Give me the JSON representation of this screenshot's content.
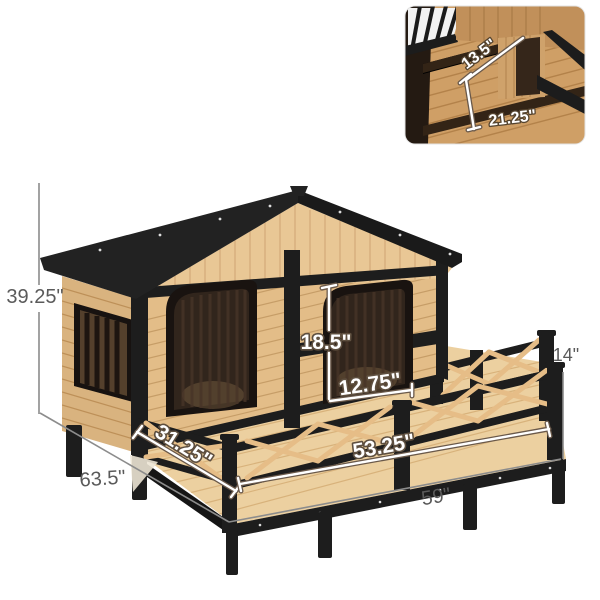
{
  "figure": {
    "type": "product-dimension-diagram",
    "subject": "wooden dog house with porch deck and inset interior view"
  },
  "dimensions": {
    "overall_height": "39.25\"",
    "overall_depth": "63.5\"",
    "overall_width": "59\"",
    "deck_length": "53.25\"",
    "deck_side_depth": "31.25\"",
    "door_height": "18.5\"",
    "door_width": "12.75\"",
    "railing_height": "14\"",
    "inset_width": "13.5\"",
    "inset_height": "21.25\""
  },
  "colors": {
    "background": "#ffffff",
    "roof_black": "#222222",
    "trim_black": "#1d1d1d",
    "siding_wood": "#e3bd88",
    "gable_wood": "#e9c795",
    "deck_wood": "#ecd0a0",
    "door_tint": "#31251c",
    "dimension_text_gray": "#5a5a5a",
    "dimension_text_white": "#ffffff"
  }
}
